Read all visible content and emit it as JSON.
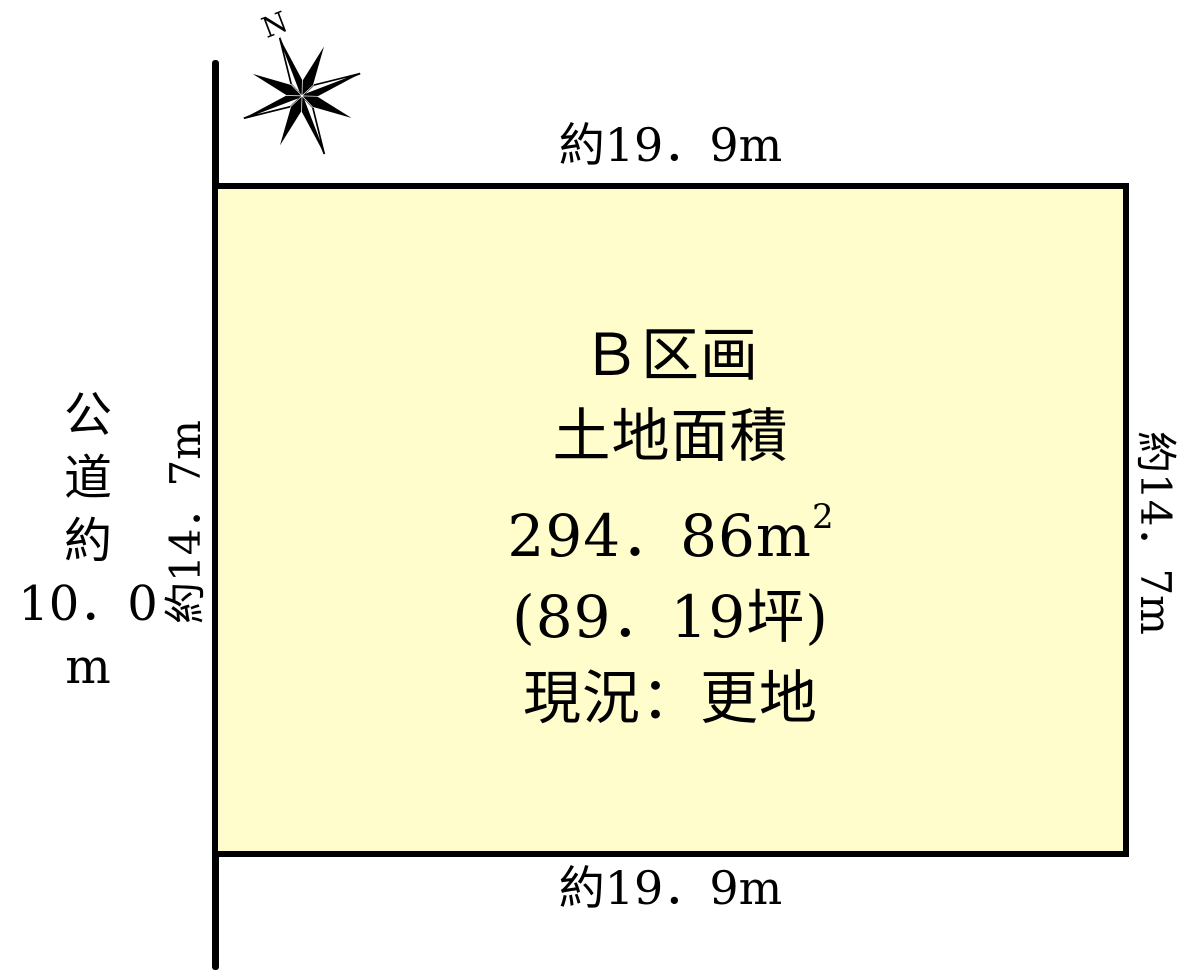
{
  "compass": {
    "north": "N"
  },
  "dimensions": {
    "top": "約19．9m",
    "bottom": "約19．9m",
    "left": "約14．7m",
    "right": "約14．7m"
  },
  "road": {
    "chars": [
      "公",
      "道",
      "約",
      "10．0",
      "m"
    ]
  },
  "plot": {
    "name": "Ｂ区画",
    "area_title": "土地面積",
    "area_base": "294．86m",
    "area_sup": "2",
    "area_tsubo": "(89．19坪)",
    "status": "現況：更地",
    "fill_color": "#FFFDCB",
    "line_color": "#000000"
  }
}
